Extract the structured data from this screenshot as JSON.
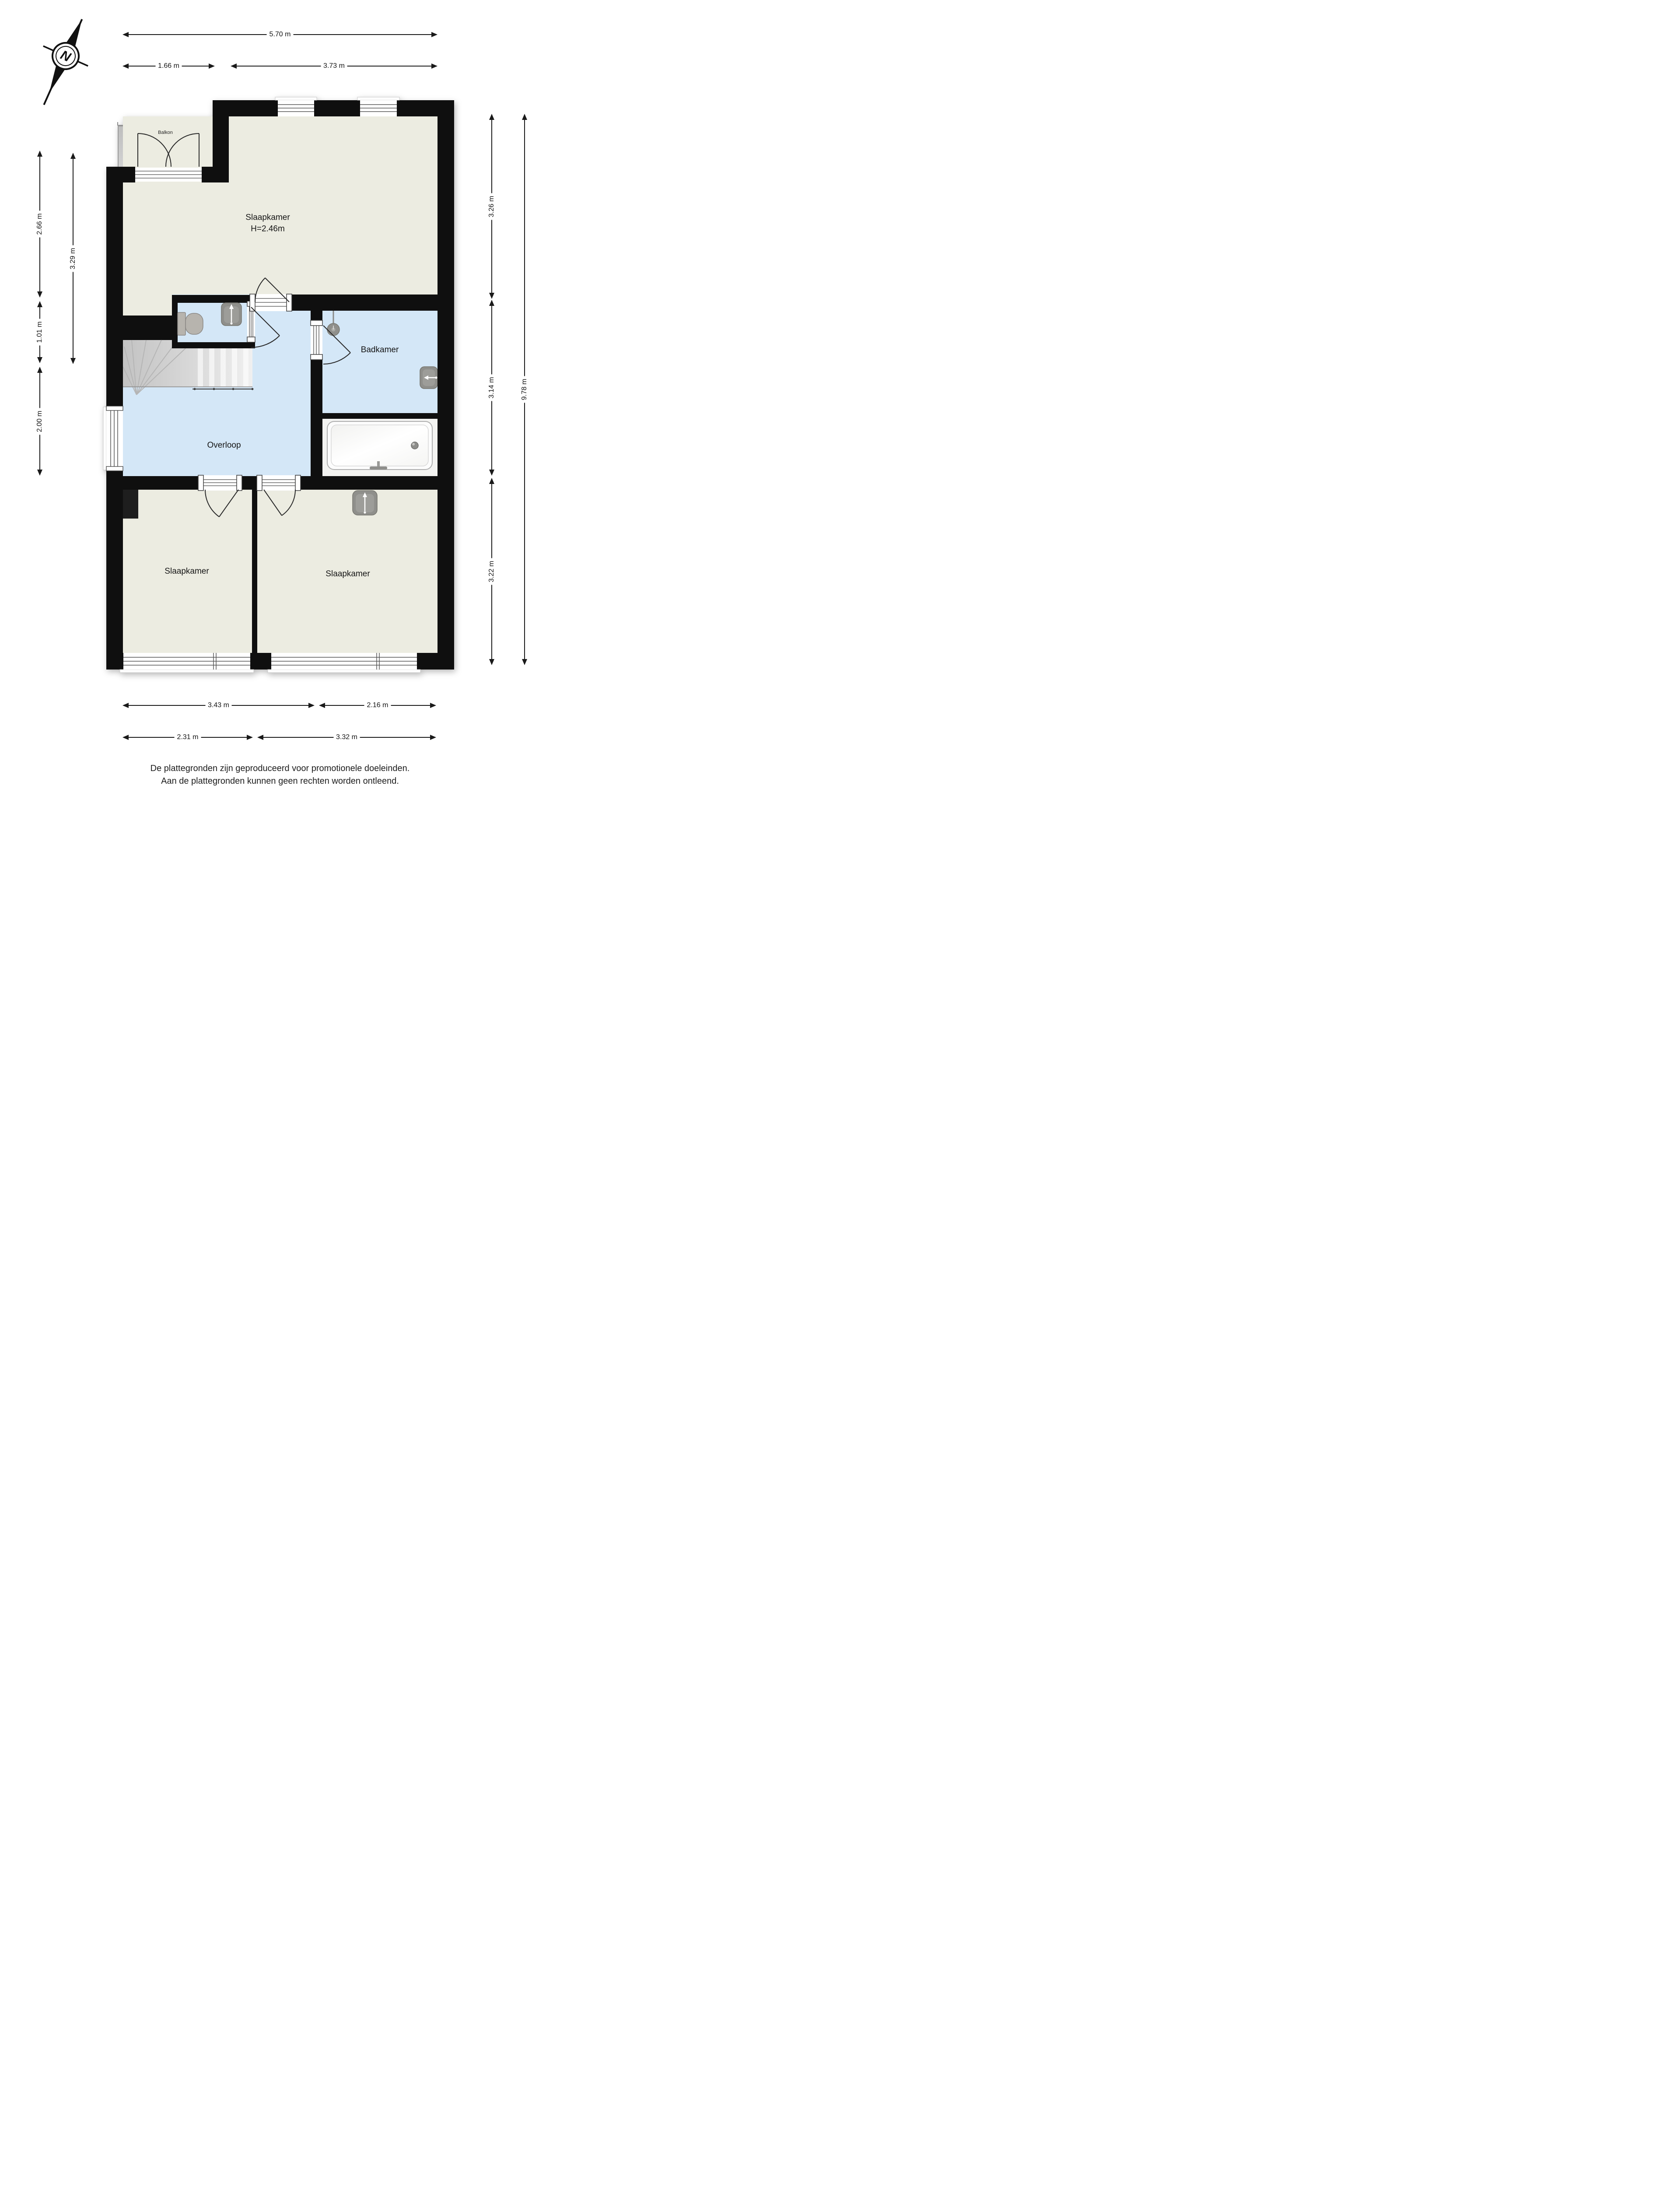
{
  "compass": {
    "north_label": "N"
  },
  "balcony": {
    "label": "Balkon"
  },
  "rooms": {
    "bedroom_main": {
      "label": "Slaapkamer",
      "ceiling_height": "H=2.46m"
    },
    "bathroom": {
      "label": "Badkamer"
    },
    "landing": {
      "label": "Overloop"
    },
    "bedroom_left": {
      "label": "Slaapkamer"
    },
    "bedroom_right": {
      "label": "Slaapkamer"
    }
  },
  "dimensions": {
    "top_total": "5.70 m",
    "top_left": "1.66 m",
    "top_right": "3.73 m",
    "left_upper": "2.66 m",
    "left_middle": "1.01 m",
    "left_lower": "2.00 m",
    "left_inner": "3.29 m",
    "right_upper": "3.26 m",
    "right_middle": "3.14 m",
    "right_lower": "3.22 m",
    "right_total": "9.78 m",
    "bottom_row1_left": "3.43 m",
    "bottom_row1_right": "2.16 m",
    "bottom_row2_left": "2.31 m",
    "bottom_row2_right": "3.32 m"
  },
  "footer": {
    "line1": "De plattegronden zijn geproduceerd voor promotionele doeleinden.",
    "line2": "Aan de plattegronden kunnen geen rechten worden ontleend."
  },
  "colors": {
    "wall": "#0f0f0f",
    "room_floor": "#ECECE1",
    "wet_floor": "#D4E7F7",
    "balcony": "#C9C9C9",
    "stairs": "#D2D2D2",
    "fixture": "#8F8F8B",
    "dimension": "#1A1A1A"
  }
}
